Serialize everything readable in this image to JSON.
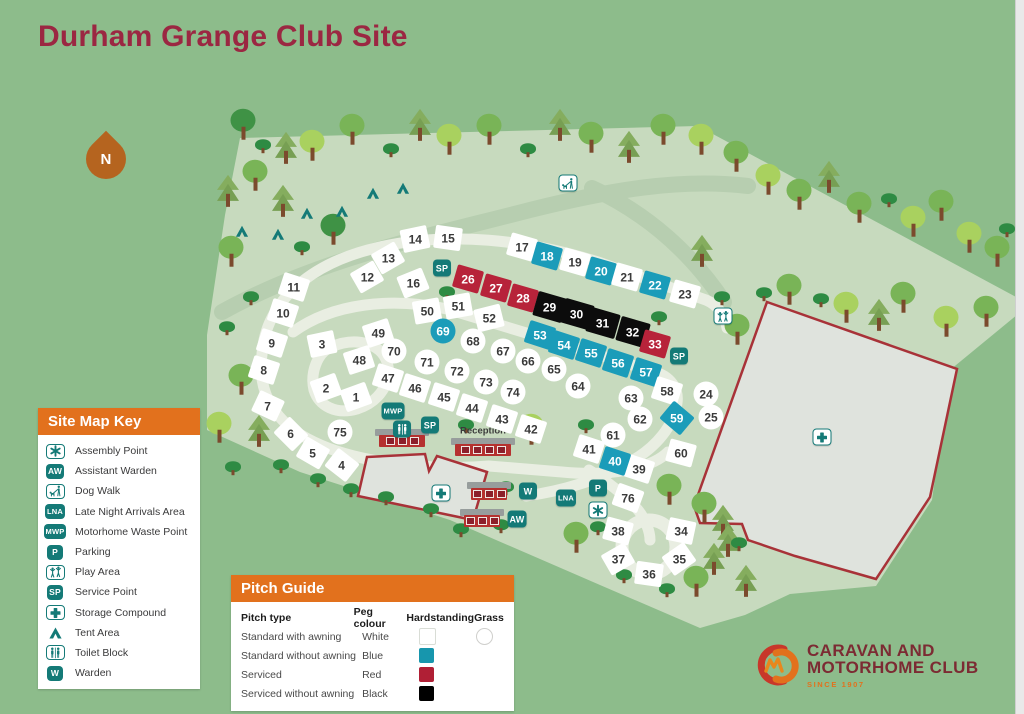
{
  "page": {
    "title": "Durham Grange Club Site"
  },
  "north": {
    "label": "N"
  },
  "key": {
    "title": "Site Map Key",
    "items": [
      {
        "icon": "assembly",
        "style": "outline",
        "label": "Assembly Point"
      },
      {
        "icon": "AW",
        "style": "solid",
        "label": "Assistant Warden"
      },
      {
        "icon": "dogwalk",
        "style": "outline",
        "label": "Dog Walk"
      },
      {
        "icon": "LNA",
        "style": "solid",
        "label": "Late Night Arrivals Area"
      },
      {
        "icon": "MWP",
        "style": "solid",
        "label": "Motorhome Waste Point"
      },
      {
        "icon": "P",
        "style": "solid",
        "label": "Parking"
      },
      {
        "icon": "play",
        "style": "outline",
        "label": "Play Area"
      },
      {
        "icon": "SP",
        "style": "solid",
        "label": "Service Point"
      },
      {
        "icon": "storage",
        "style": "outline",
        "label": "Storage Compound"
      },
      {
        "icon": "tent",
        "style": "plain",
        "label": "Tent Area"
      },
      {
        "icon": "toilet",
        "style": "outline",
        "label": "Toilet Block"
      },
      {
        "icon": "W",
        "style": "solid",
        "label": "Warden"
      }
    ]
  },
  "pitch_guide": {
    "title": "Pitch Guide",
    "columns": [
      "Pitch type",
      "Peg colour",
      "Hardstanding",
      "Grass"
    ],
    "rows": [
      {
        "type": "Standard with awning",
        "peg": "White",
        "hardstanding": "#ffffff",
        "grass": true
      },
      {
        "type": "Standard without awning",
        "peg": "Blue",
        "hardstanding": "#1796ad",
        "grass": false
      },
      {
        "type": "Serviced",
        "peg": "Red",
        "hardstanding": "#b01f35",
        "grass": false
      },
      {
        "type": "Serviced without awning",
        "peg": "Black",
        "hardstanding": "#000000",
        "grass": false
      }
    ]
  },
  "logo": {
    "line1": "CARAVAN AND",
    "line2": "MOTORHOME CLUB",
    "tagline": "SINCE 1907"
  },
  "map": {
    "colors": {
      "page": "#8dbc8b",
      "ground": "#c7dabe",
      "band": "#b7ceb0",
      "road": "#e9eee2",
      "compound_fill": "#dfe3dd",
      "compound_border": "#a83238",
      "teal": "#147a77",
      "blue": "#1b9cb9",
      "red": "#b7233a",
      "black": "#0c0c0c"
    },
    "ground_polygon": "207,335 225,215 240,138 698,126 1018,298 1018,314 950,370 932,500 876,586 790,594 745,615 700,628 600,585 450,520 300,472 207,430",
    "bands": [
      "M 222,312 C 320,258 430,236 530,210 C 610,190 680,178 748,186",
      "M 592,188 C 648,214 692,254 724,302"
    ],
    "roads": [
      "M 262,354 C 266,300 312,262 380,247 C 450,231 528,240 598,262 L 706,300 C 718,305 725,316 727,328",
      "M 293,332 C 333,303 392,297 447,309 L 652,371 C 671,376 679,389 677,403 C 674,425 657,447 630,462 C 600,480 562,491 526,496",
      "M 262,354 C 257,392 274,423 314,442 C 357,463 432,471 489,466 L 562,472 C 612,477 652,468 668,452",
      "M 331,347 C 357,336 381,344 387,362 C 393,382 379,402 357,409 C 336,415 319,406 314,390 C 310,373 317,353 331,347",
      "M 589,470 C 605,480 625,495 638,510 C 646,520 650,532 650,540"
    ],
    "culdesac": {
      "cx": 649,
      "cy": 547,
      "r": 27
    },
    "compounds": [
      "767,302 957,369 930,497 876,579 795,556 748,540 742,524 700,523 694,506",
      "367,457 425,454 429,471 437,456 487,472 473,520 358,496"
    ],
    "pitches": [
      [
        1,
        356,
        397,
        "w",
        "r",
        -20
      ],
      [
        2,
        326,
        388,
        "w",
        "r",
        -20
      ],
      [
        3,
        322,
        344,
        "w",
        "r",
        -12
      ],
      [
        4,
        342,
        465,
        "w",
        "r",
        38
      ],
      [
        5,
        313,
        453,
        "w",
        "r",
        30
      ],
      [
        6,
        291,
        434,
        "w",
        "r",
        45
      ],
      [
        7,
        268,
        406,
        "w",
        "r",
        25
      ],
      [
        8,
        264,
        370,
        "w",
        "r",
        18
      ],
      [
        9,
        272,
        343,
        "w",
        "r",
        18
      ],
      [
        10,
        283,
        313,
        "w",
        "r",
        18
      ],
      [
        11,
        294,
        287,
        "w",
        "r",
        18
      ],
      [
        12,
        367,
        277,
        "w",
        "r",
        -30
      ],
      [
        13,
        388,
        258,
        "w",
        "r",
        -30
      ],
      [
        14,
        415,
        239,
        "w",
        "r",
        -12
      ],
      [
        15,
        448,
        238,
        "w",
        "r",
        8
      ],
      [
        16,
        413,
        283,
        "w",
        "r",
        -22
      ],
      [
        17,
        522,
        247,
        "w",
        "r",
        16
      ],
      [
        18,
        547,
        256,
        "b",
        "r",
        16
      ],
      [
        19,
        575,
        262,
        "w",
        "r",
        16
      ],
      [
        20,
        601,
        271,
        "b",
        "r",
        16
      ],
      [
        21,
        627,
        277,
        "w",
        "r",
        16
      ],
      [
        22,
        655,
        285,
        "b",
        "r",
        16
      ],
      [
        23,
        685,
        294,
        "w",
        "r",
        16
      ],
      [
        24,
        706,
        394,
        "w",
        "o",
        0
      ],
      [
        25,
        711,
        417,
        "w",
        "o",
        0
      ],
      [
        26,
        468,
        279,
        "r",
        "r",
        16
      ],
      [
        27,
        496,
        288,
        "r",
        "r",
        16
      ],
      [
        28,
        523,
        298,
        "r",
        "r",
        16
      ],
      [
        29,
        550,
        307,
        "k",
        "r",
        16
      ],
      [
        30,
        577,
        314,
        "k",
        "r",
        16
      ],
      [
        31,
        603,
        323,
        "k",
        "r",
        16
      ],
      [
        32,
        633,
        332,
        "k",
        "r",
        16
      ],
      [
        33,
        655,
        344,
        "r",
        "r",
        16
      ],
      [
        34,
        681,
        531,
        "w",
        "r",
        12
      ],
      [
        35,
        679,
        559,
        "w",
        "r",
        -35
      ],
      [
        36,
        649,
        574,
        "w",
        "r",
        8
      ],
      [
        37,
        618,
        559,
        "w",
        "r",
        -30
      ],
      [
        38,
        618,
        531,
        "w",
        "r",
        15
      ],
      [
        39,
        639,
        469,
        "w",
        "r",
        18
      ],
      [
        40,
        615,
        461,
        "b",
        "r",
        18
      ],
      [
        41,
        589,
        449,
        "w",
        "r",
        18
      ],
      [
        42,
        531,
        429,
        "w",
        "r",
        18
      ],
      [
        43,
        502,
        419,
        "w",
        "r",
        18
      ],
      [
        44,
        472,
        408,
        "w",
        "r",
        18
      ],
      [
        45,
        444,
        397,
        "w",
        "r",
        18
      ],
      [
        46,
        415,
        388,
        "w",
        "r",
        18
      ],
      [
        47,
        388,
        378,
        "w",
        "r",
        18
      ],
      [
        48,
        359,
        360,
        "w",
        "r",
        -18
      ],
      [
        49,
        378,
        333,
        "w",
        "r",
        -18
      ],
      [
        50,
        427,
        311,
        "w",
        "r",
        -10
      ],
      [
        51,
        458,
        306,
        "w",
        "r",
        -10
      ],
      [
        52,
        489,
        318,
        "w",
        "r",
        -14
      ],
      [
        53,
        540,
        335,
        "b",
        "r",
        18
      ],
      [
        54,
        564,
        345,
        "b",
        "r",
        18
      ],
      [
        55,
        591,
        353,
        "b",
        "r",
        18
      ],
      [
        56,
        618,
        363,
        "b",
        "r",
        18
      ],
      [
        57,
        646,
        372,
        "b",
        "r",
        18
      ],
      [
        58,
        667,
        391,
        "w",
        "r",
        18
      ],
      [
        59,
        677,
        418,
        "b",
        "r",
        40
      ],
      [
        60,
        681,
        453,
        "w",
        "r",
        15
      ],
      [
        61,
        613,
        435,
        "w",
        "o",
        0
      ],
      [
        62,
        640,
        419,
        "w",
        "o",
        0
      ],
      [
        63,
        631,
        398,
        "w",
        "o",
        0
      ],
      [
        64,
        578,
        386,
        "w",
        "o",
        0
      ],
      [
        65,
        554,
        369,
        "w",
        "o",
        0
      ],
      [
        66,
        528,
        361,
        "w",
        "o",
        0
      ],
      [
        67,
        503,
        351,
        "w",
        "o",
        0
      ],
      [
        68,
        473,
        341,
        "w",
        "o",
        0
      ],
      [
        69,
        443,
        331,
        "b",
        "o",
        0
      ],
      [
        70,
        394,
        351,
        "w",
        "o",
        0
      ],
      [
        71,
        427,
        362,
        "w",
        "o",
        0
      ],
      [
        72,
        457,
        371,
        "w",
        "o",
        0
      ],
      [
        73,
        486,
        382,
        "w",
        "o",
        0
      ],
      [
        74,
        513,
        392,
        "w",
        "o",
        0
      ],
      [
        75,
        340,
        432,
        "w",
        "o",
        0
      ],
      [
        76,
        628,
        498,
        "w",
        "r",
        20
      ]
    ],
    "icons": [
      {
        "t": "SP",
        "x": 442,
        "y": 268
      },
      {
        "t": "SP",
        "x": 430,
        "y": 425
      },
      {
        "t": "SP",
        "x": 679,
        "y": 356
      },
      {
        "t": "MWP",
        "x": 393,
        "y": 411
      },
      {
        "t": "P",
        "x": 598,
        "y": 488
      },
      {
        "t": "LNA",
        "x": 566,
        "y": 498
      },
      {
        "t": "W",
        "x": 528,
        "y": 491
      },
      {
        "t": "AW",
        "x": 517,
        "y": 519
      },
      {
        "t": "assembly",
        "x": 598,
        "y": 510
      },
      {
        "t": "dogwalk",
        "x": 568,
        "y": 183
      },
      {
        "t": "play",
        "x": 723,
        "y": 316
      },
      {
        "t": "toilet",
        "x": 402,
        "y": 429,
        "v": "solid"
      },
      {
        "t": "storage",
        "x": 822,
        "y": 437
      },
      {
        "t": "storage",
        "x": 441,
        "y": 493
      }
    ],
    "tents": [
      [
        373,
        197
      ],
      [
        403,
        192
      ],
      [
        307,
        217
      ],
      [
        342,
        215
      ],
      [
        242,
        235
      ],
      [
        278,
        238
      ]
    ],
    "trees": [
      [
        243,
        136,
        "e"
      ],
      [
        263,
        149,
        "b"
      ],
      [
        286,
        160,
        "c"
      ],
      [
        312,
        157,
        "y"
      ],
      [
        352,
        141,
        "d"
      ],
      [
        391,
        153,
        "b"
      ],
      [
        420,
        137,
        "c"
      ],
      [
        449,
        151,
        "y"
      ],
      [
        489,
        141,
        "d"
      ],
      [
        528,
        153,
        "b"
      ],
      [
        560,
        137,
        "c"
      ],
      [
        591,
        149,
        "d"
      ],
      [
        629,
        159,
        "c"
      ],
      [
        663,
        141,
        "d"
      ],
      [
        701,
        151,
        "y"
      ],
      [
        736,
        168,
        "d"
      ],
      [
        768,
        191,
        "y"
      ],
      [
        799,
        206,
        "d"
      ],
      [
        829,
        189,
        "c"
      ],
      [
        859,
        219,
        "d"
      ],
      [
        889,
        203,
        "b"
      ],
      [
        913,
        233,
        "y"
      ],
      [
        941,
        217,
        "d"
      ],
      [
        969,
        249,
        "y"
      ],
      [
        997,
        263,
        "d"
      ],
      [
        1007,
        233,
        "b"
      ],
      [
        228,
        203,
        "c"
      ],
      [
        255,
        187,
        "d"
      ],
      [
        283,
        213,
        "c"
      ],
      [
        231,
        263,
        "d"
      ],
      [
        251,
        301,
        "b"
      ],
      [
        227,
        331,
        "b"
      ],
      [
        241,
        391,
        "d"
      ],
      [
        219,
        439,
        "y"
      ],
      [
        259,
        443,
        "c"
      ],
      [
        233,
        471,
        "b"
      ],
      [
        302,
        251,
        "b"
      ],
      [
        333,
        241,
        "e"
      ],
      [
        447,
        296,
        "b"
      ],
      [
        586,
        429,
        "b"
      ],
      [
        659,
        321,
        "b"
      ],
      [
        737,
        341,
        "d"
      ],
      [
        702,
        263,
        "c"
      ],
      [
        722,
        301,
        "b"
      ],
      [
        764,
        297,
        "b"
      ],
      [
        789,
        301,
        "d"
      ],
      [
        821,
        303,
        "b"
      ],
      [
        846,
        319,
        "y"
      ],
      [
        879,
        327,
        "c"
      ],
      [
        903,
        309,
        "d"
      ],
      [
        946,
        333,
        "y"
      ],
      [
        986,
        323,
        "d"
      ],
      [
        669,
        501,
        "d"
      ],
      [
        704,
        519,
        "d"
      ],
      [
        723,
        533,
        "c"
      ],
      [
        728,
        553,
        "c"
      ],
      [
        576,
        549,
        "d"
      ],
      [
        598,
        531,
        "b"
      ],
      [
        624,
        579,
        "b"
      ],
      [
        696,
        593,
        "d"
      ],
      [
        714,
        571,
        "c"
      ],
      [
        739,
        547,
        "b"
      ],
      [
        667,
        593,
        "b"
      ],
      [
        746,
        593,
        "c"
      ],
      [
        531,
        441,
        "y"
      ],
      [
        466,
        429,
        "b"
      ],
      [
        506,
        491,
        "b"
      ],
      [
        431,
        513,
        "b"
      ],
      [
        461,
        533,
        "b"
      ],
      [
        501,
        529,
        "b"
      ],
      [
        281,
        469,
        "b"
      ],
      [
        318,
        483,
        "b"
      ],
      [
        351,
        493,
        "b"
      ],
      [
        386,
        501,
        "b"
      ]
    ],
    "buildings": [
      {
        "x": 402,
        "y": 441,
        "w": 46
      },
      {
        "x": 483,
        "y": 450,
        "w": 56
      },
      {
        "x": 489,
        "y": 494,
        "w": 36
      },
      {
        "x": 482,
        "y": 521,
        "w": 36
      }
    ],
    "labels": [
      {
        "text": "Reception",
        "x": 483,
        "y": 431
      }
    ]
  }
}
